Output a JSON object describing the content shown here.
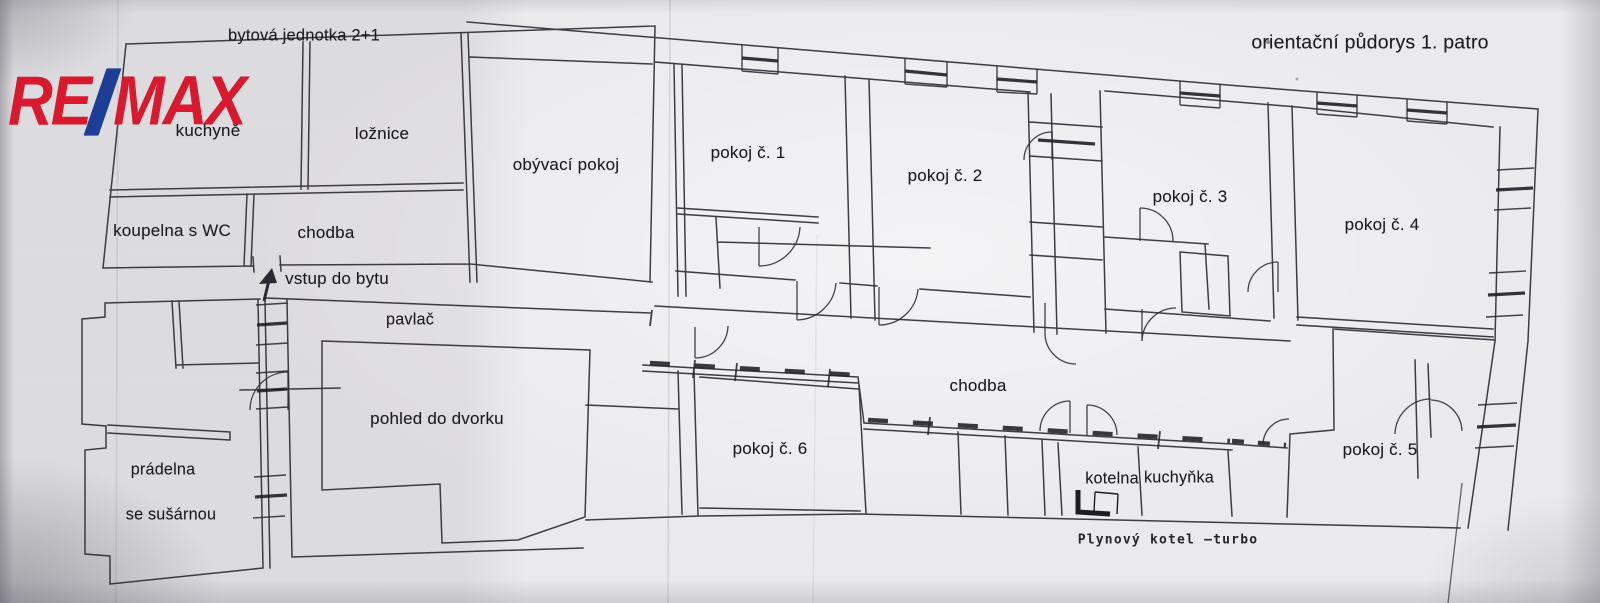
{
  "logo": {
    "part1": "RE",
    "part2": "MAX",
    "red": "#d8192e",
    "blue": "#1d3e97"
  },
  "titles": {
    "unit": "bytová jednotka 2+1",
    "plan": "orientační půdorys 1. patro"
  },
  "apartment": {
    "kitchen": "kuchyně",
    "bedroom": "ložnice",
    "living_room": "obývací pokoj",
    "bathroom": "koupelna s WC",
    "hall": "chodba",
    "entrance": "vstup do bytu"
  },
  "building": {
    "room1": "pokoj č. 1",
    "room2": "pokoj č. 2",
    "room3": "pokoj č. 3",
    "room4": "pokoj č. 4",
    "room5": "pokoj č. 5",
    "room6": "pokoj č. 6",
    "corridor": "chodba",
    "boiler_room": "kotelna",
    "kitchenette": "kuchyňka",
    "boiler_note": "Plynový kotel –turbo"
  },
  "courtyard": {
    "gallery": "pavlač",
    "view": "pohled do dvorku",
    "laundry_line1": "prádelna",
    "laundry_line2": "se sušárnou"
  }
}
